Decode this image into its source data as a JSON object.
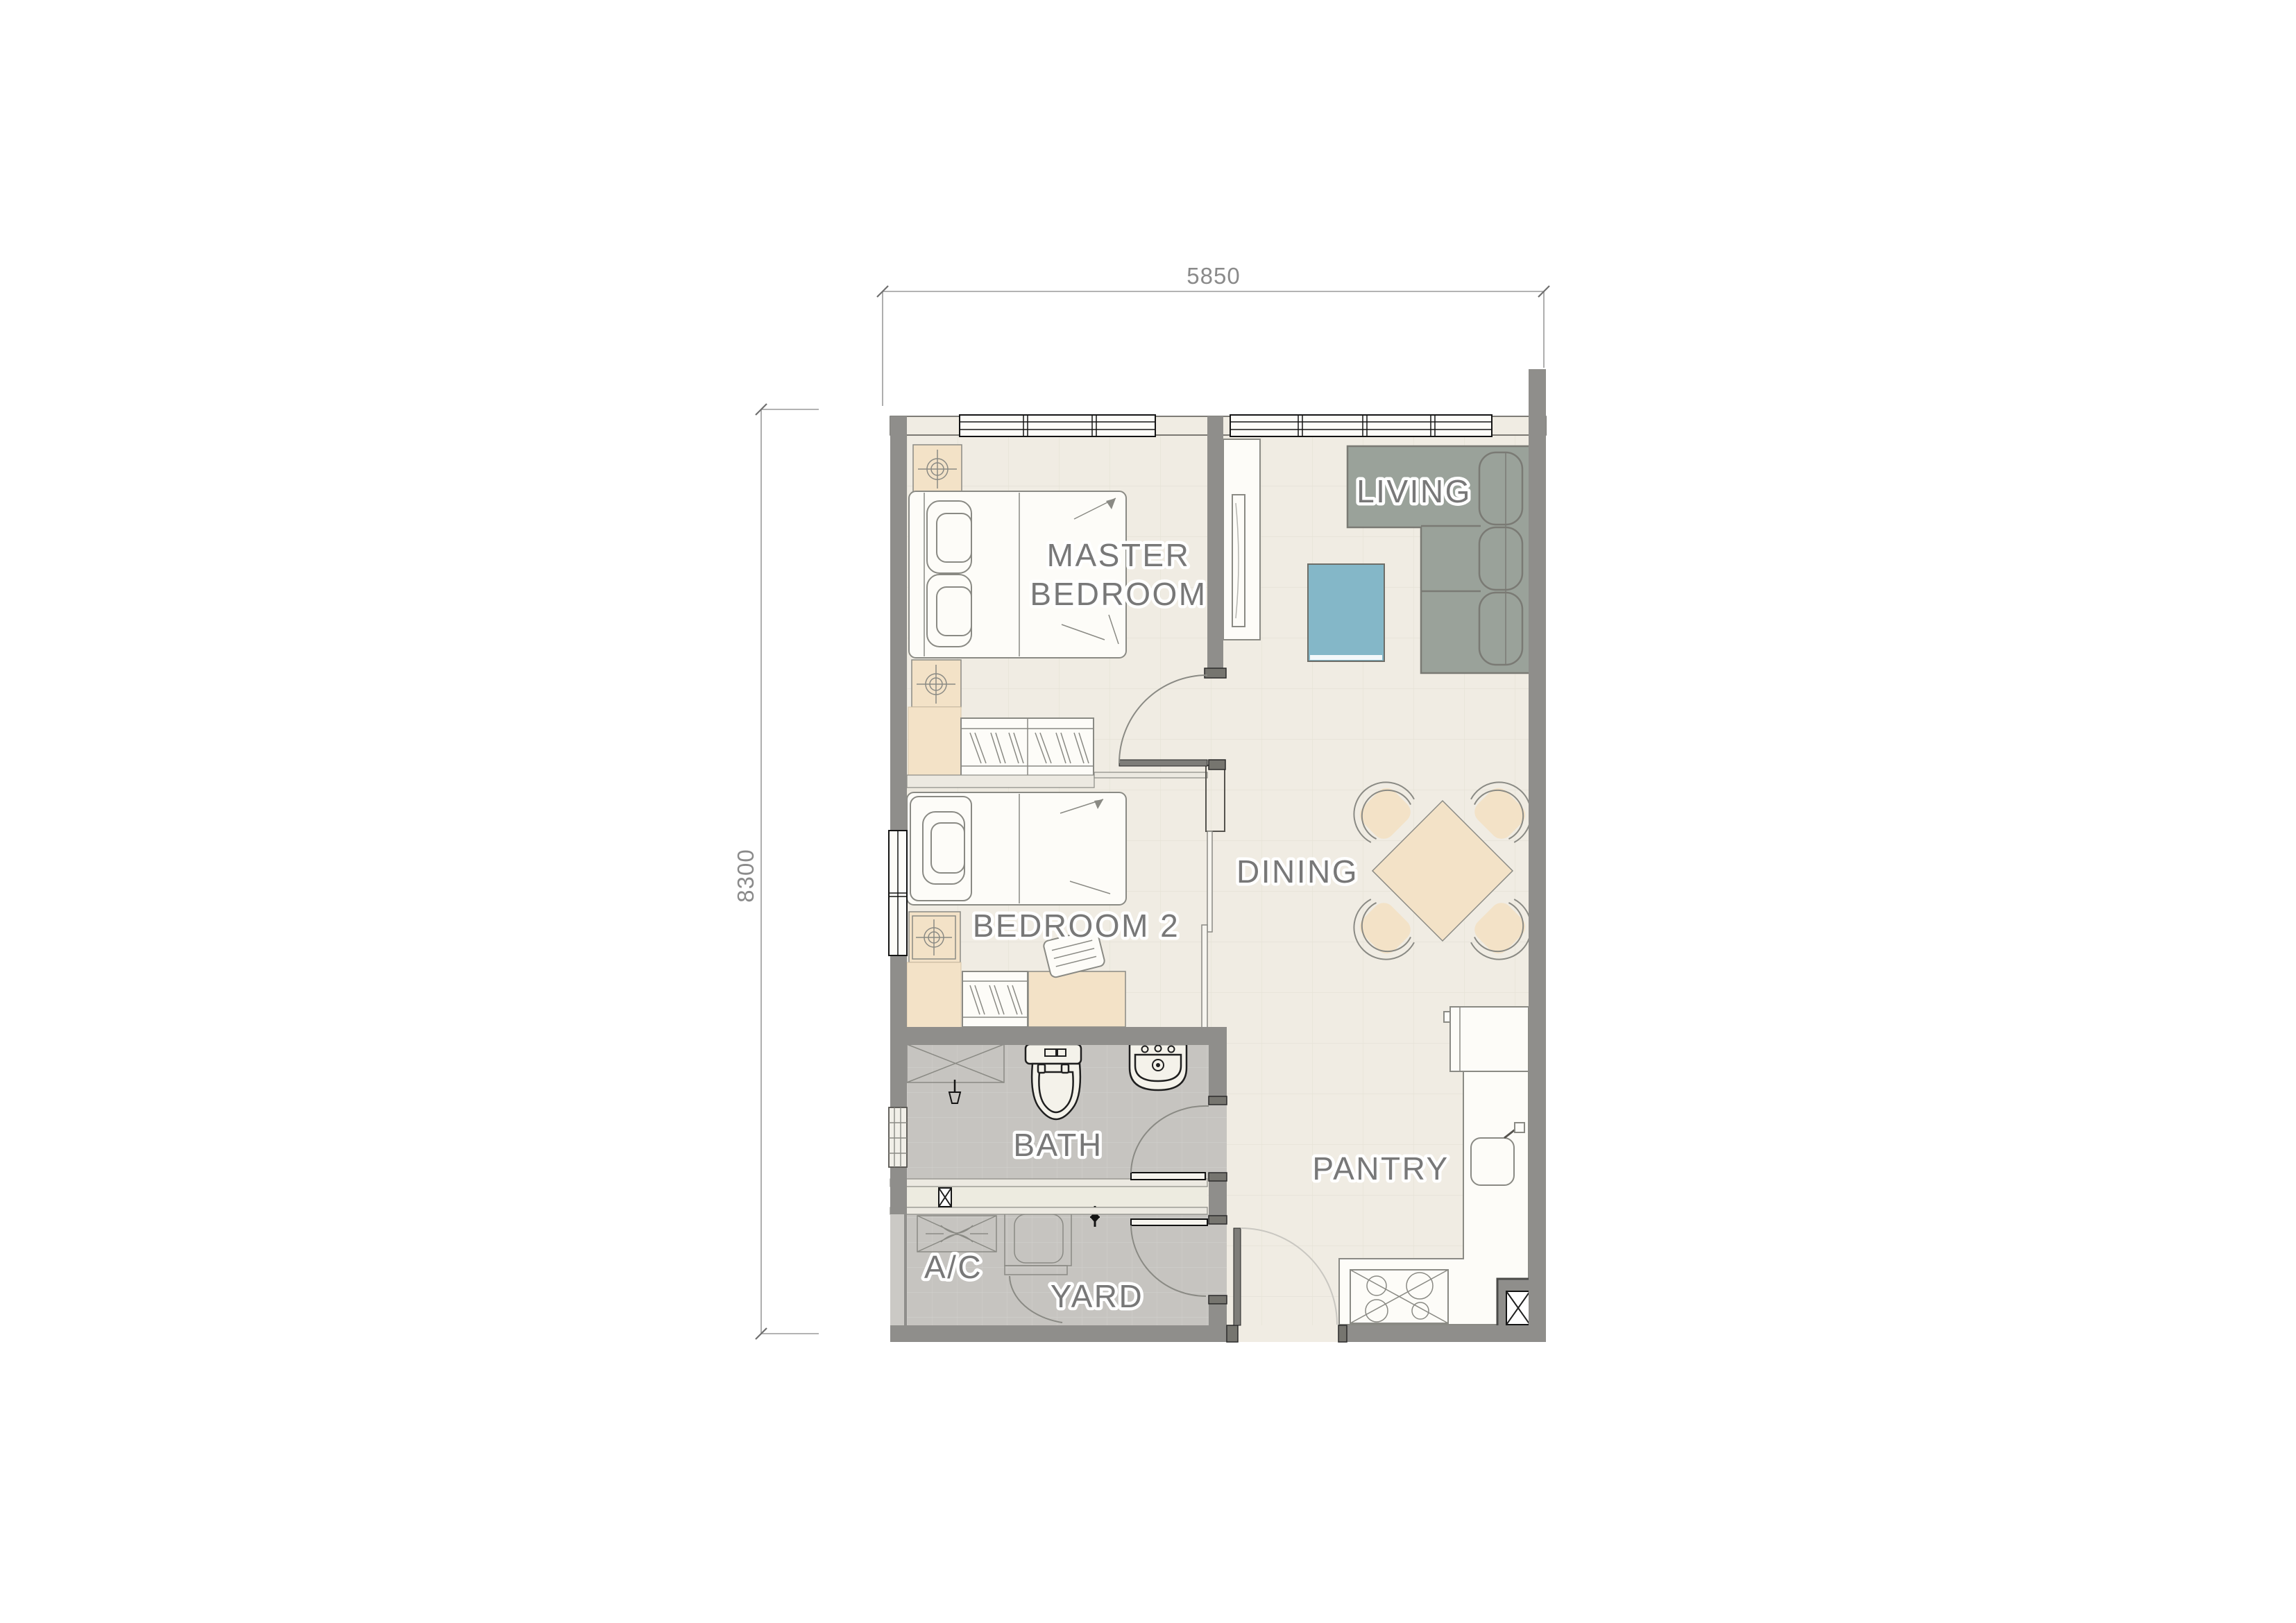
{
  "dimensions": {
    "top_label": "5850",
    "left_label": "8300"
  },
  "rooms": {
    "master_bedroom_line1": "MASTER",
    "master_bedroom_line2": "BEDROOM",
    "bedroom2": "BEDROOM 2",
    "living": "LIVING",
    "dining": "DINING",
    "bath": "BATH",
    "pantry": "PANTRY",
    "ac": "A/C",
    "yard": "YARD"
  },
  "colors": {
    "wall": "#8f8e8b",
    "floor": "#f0ece3",
    "wet_floor": "#c6c4c0",
    "shaft_band": "#edebe0",
    "furniture_tan": "#f3e2c7",
    "sofa": "#9aa29a",
    "coffee_table": "#84b7c8",
    "room_label": "#787878",
    "dimension": "#8a8a8a"
  }
}
